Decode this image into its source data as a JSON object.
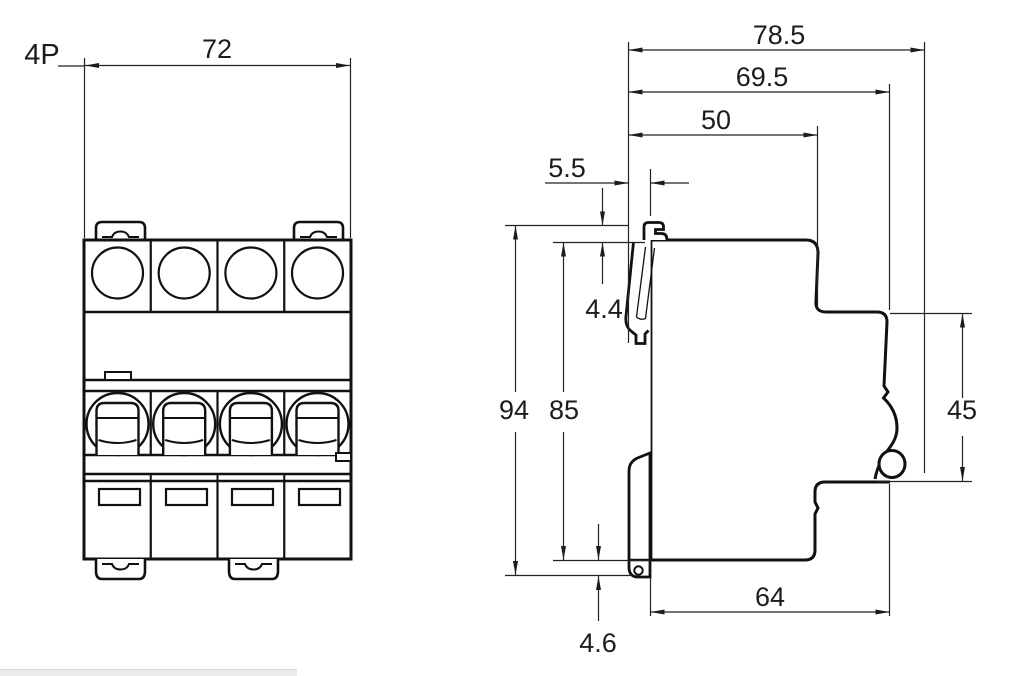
{
  "drawing_labels": {
    "front": {
      "pole_count": "4P",
      "width": "72"
    },
    "side": {
      "total_depth": "78.5",
      "terminal_depth": "69.5",
      "step_depth": "50",
      "handle_protrusion": "5.5",
      "handle_drop": "4.4",
      "overall_height": "94",
      "body_height": "85",
      "front_height": "45",
      "base_depth": "64",
      "clip_drop": "4.6"
    }
  },
  "colors": {
    "outline": "#111111",
    "dimension_line": "#222222",
    "background": "#ffffff",
    "scrollbar": "#ececec"
  }
}
